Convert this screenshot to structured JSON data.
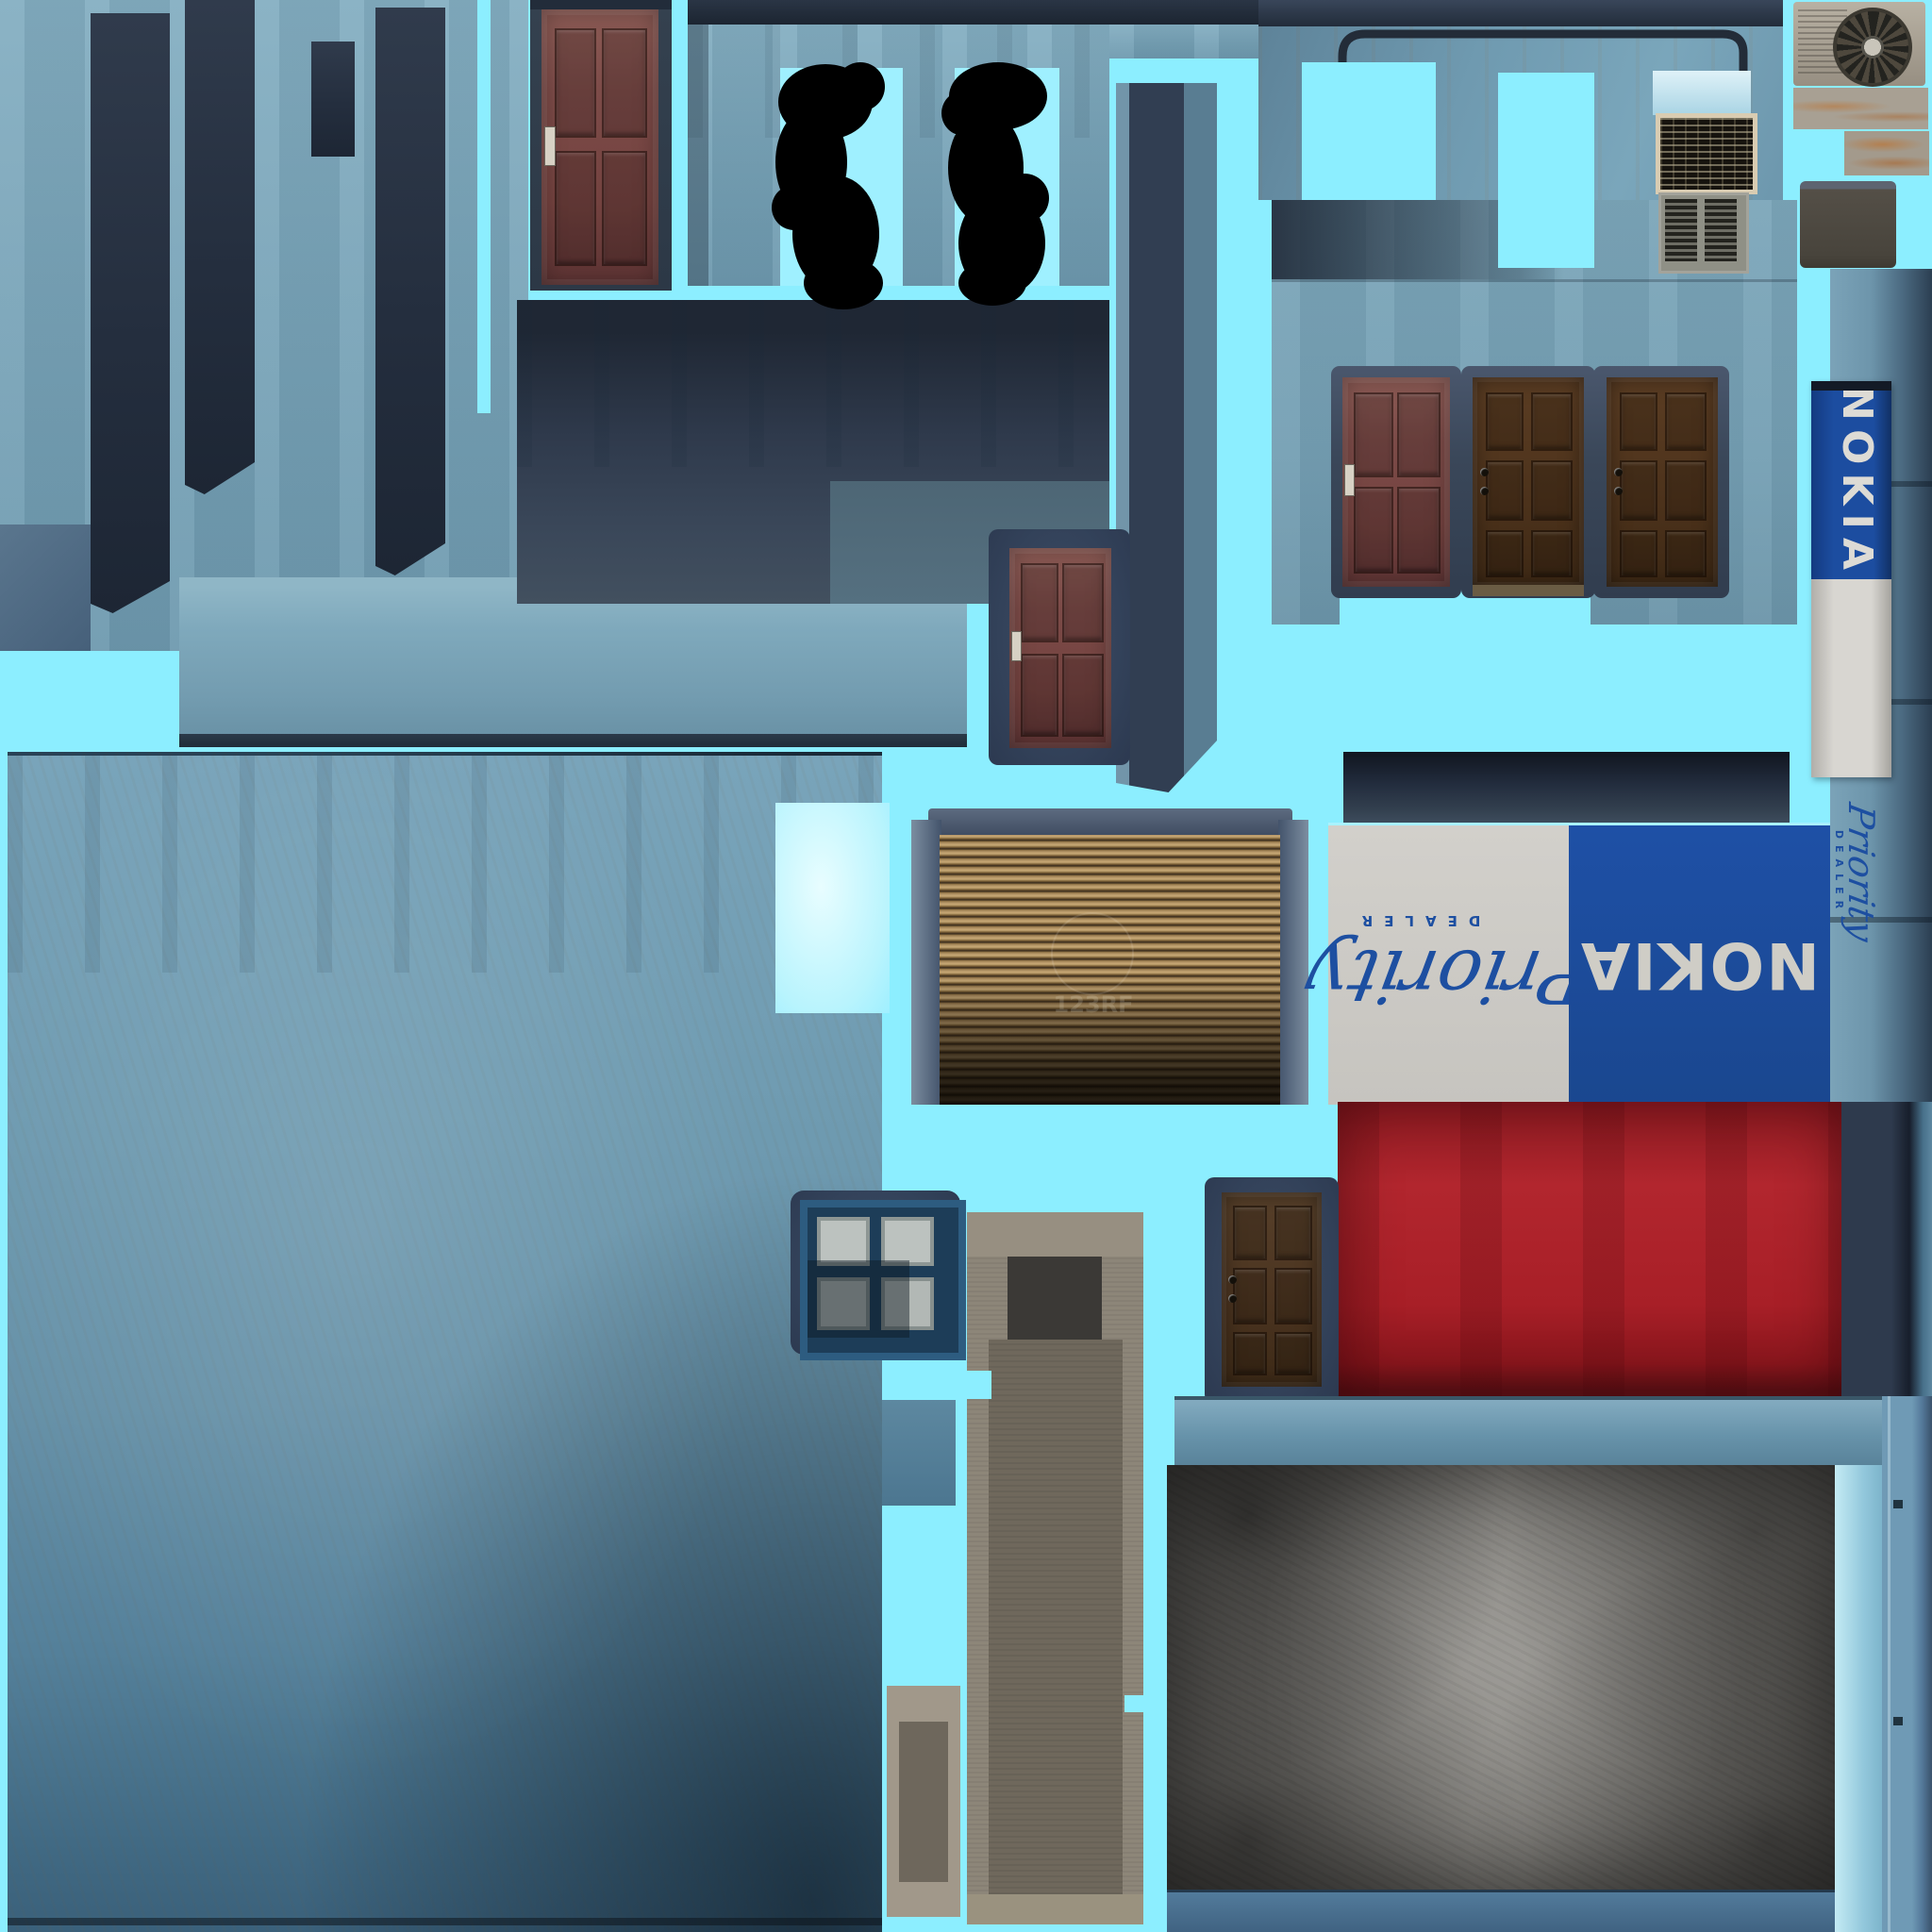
{
  "atlas": {
    "signs": {
      "vertical": {
        "brand": "NOKIA",
        "script": "Priority",
        "dealer": "DEALER"
      },
      "horizontal": {
        "brand": "NOKIA",
        "script": "Priority",
        "dealer": "DEALER"
      }
    },
    "watermark": "123RF",
    "colors": {
      "background_mask_cyan": "#8ceeff",
      "nokia_blue": "#1c4da0",
      "sign_gray": "#cbc9c4",
      "script_blue": "#1d4fa1",
      "red_wall": "#a81f27",
      "shutter_brown": "#8a6d42",
      "door_maroon": "#7b4a47",
      "door_brown": "#4e341d",
      "concrete_light": "#7fa9bd",
      "concrete_dark_bar": "#2b3547",
      "grunge_gray": "#8b8984"
    }
  }
}
